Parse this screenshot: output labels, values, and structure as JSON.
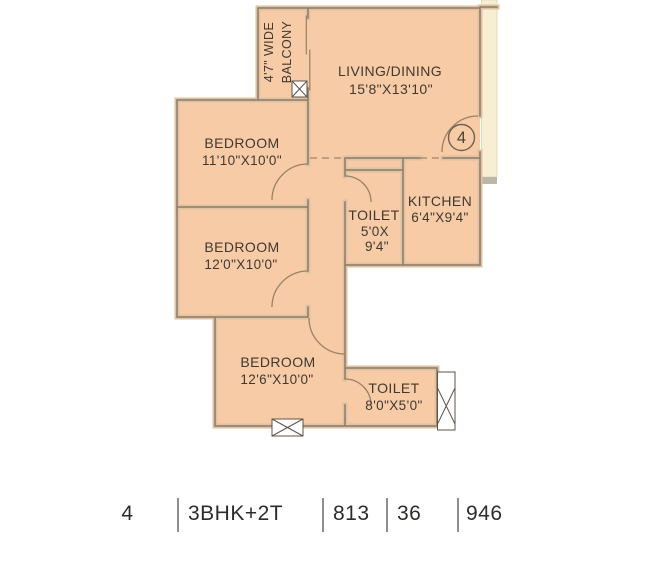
{
  "plan": {
    "unit_number": "4",
    "balcony": {
      "line1": "4'7\" WIDE",
      "line2": "BALCONY"
    },
    "living_dining": {
      "name": "LIVING/DINING",
      "dims": "15'8\"X13'10\""
    },
    "bedroom_top": {
      "name": "BEDROOM",
      "dims": "11'10\"X10'0\""
    },
    "bedroom_middle": {
      "name": "BEDROOM",
      "dims": "12'0\"X10'0\""
    },
    "bedroom_bottom": {
      "name": "BEDROOM",
      "dims": "12'6\"X10'0\""
    },
    "toilet_common": {
      "name": "TOILET",
      "dims_line1": "5'0X",
      "dims_line2": "9'4\""
    },
    "kitchen": {
      "name": "KITCHEN",
      "dims": "6'4\"X9'4\""
    },
    "toilet_attached": {
      "name": "TOILET",
      "dims": "8'0\"X5'0\""
    }
  },
  "summary": {
    "cells": [
      "4",
      "3BHK+2T",
      "813",
      "36",
      "946"
    ]
  },
  "colors": {
    "room_fill": "#f7cba6",
    "wall_line": "#8e7a66",
    "wall_band": "#ddc2a3",
    "outside_strip": "#f8eed3",
    "label_text": "#3f3931",
    "summary_text": "#2d2c2a"
  }
}
